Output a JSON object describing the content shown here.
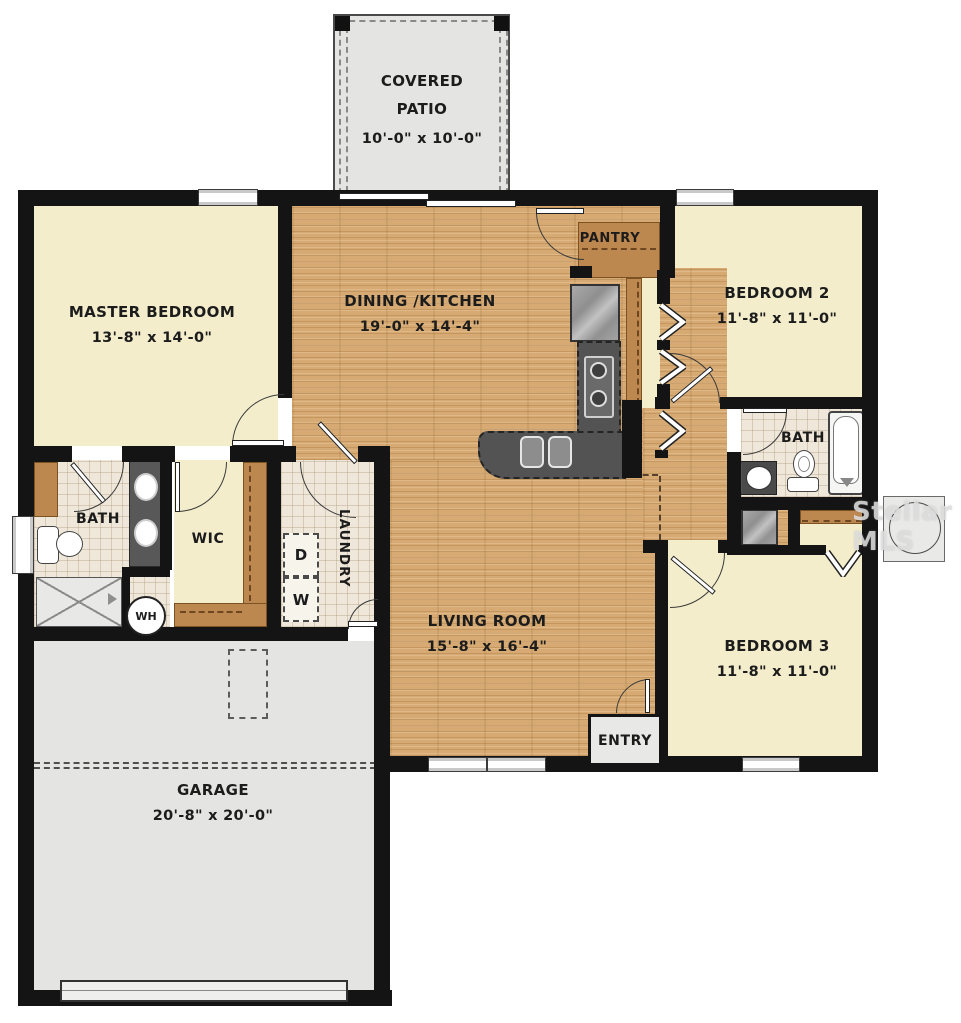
{
  "rooms": {
    "covered_patio": {
      "name": "COVERED PATIO",
      "dims": "10'-0\" x 10'-0\""
    },
    "master_bedroom": {
      "name": "MASTER BEDROOM",
      "dims": "13'-8\" x 14'-0\""
    },
    "dining_kitchen": {
      "name": "DINING /KITCHEN",
      "dims": "19'-0\" x 14'-4\""
    },
    "pantry": {
      "name": "PANTRY"
    },
    "bedroom_2": {
      "name": "BEDROOM 2",
      "dims": "11'-8\" x 11'-0\""
    },
    "hall_bath": {
      "name": "BATH"
    },
    "bedroom_3": {
      "name": "BEDROOM 3",
      "dims": "11'-8\" x 11'-0\""
    },
    "living_room": {
      "name": "LIVING ROOM",
      "dims": "15'-8\" x 16'-4\""
    },
    "entry": {
      "name": "ENTRY"
    },
    "master_bath": {
      "name": "BATH"
    },
    "wic": {
      "name": "WIC"
    },
    "laundry": {
      "name": "LAUNDRY"
    },
    "garage": {
      "name": "GARAGE",
      "dims": "20'-8\" x 20'-0\""
    }
  },
  "appliances": {
    "dryer": "D",
    "washer": "W",
    "water_heater": "WH"
  },
  "watermark": "Stellar MLS",
  "colors": {
    "wall": "#141414",
    "bedroom_floor": "#f3edcb",
    "wood_floor": "#d6aa72",
    "tile_floor": "#efe8da",
    "garage_floor": "#e4e4e2",
    "counter": "#535353",
    "shelf": "#bd8850"
  }
}
